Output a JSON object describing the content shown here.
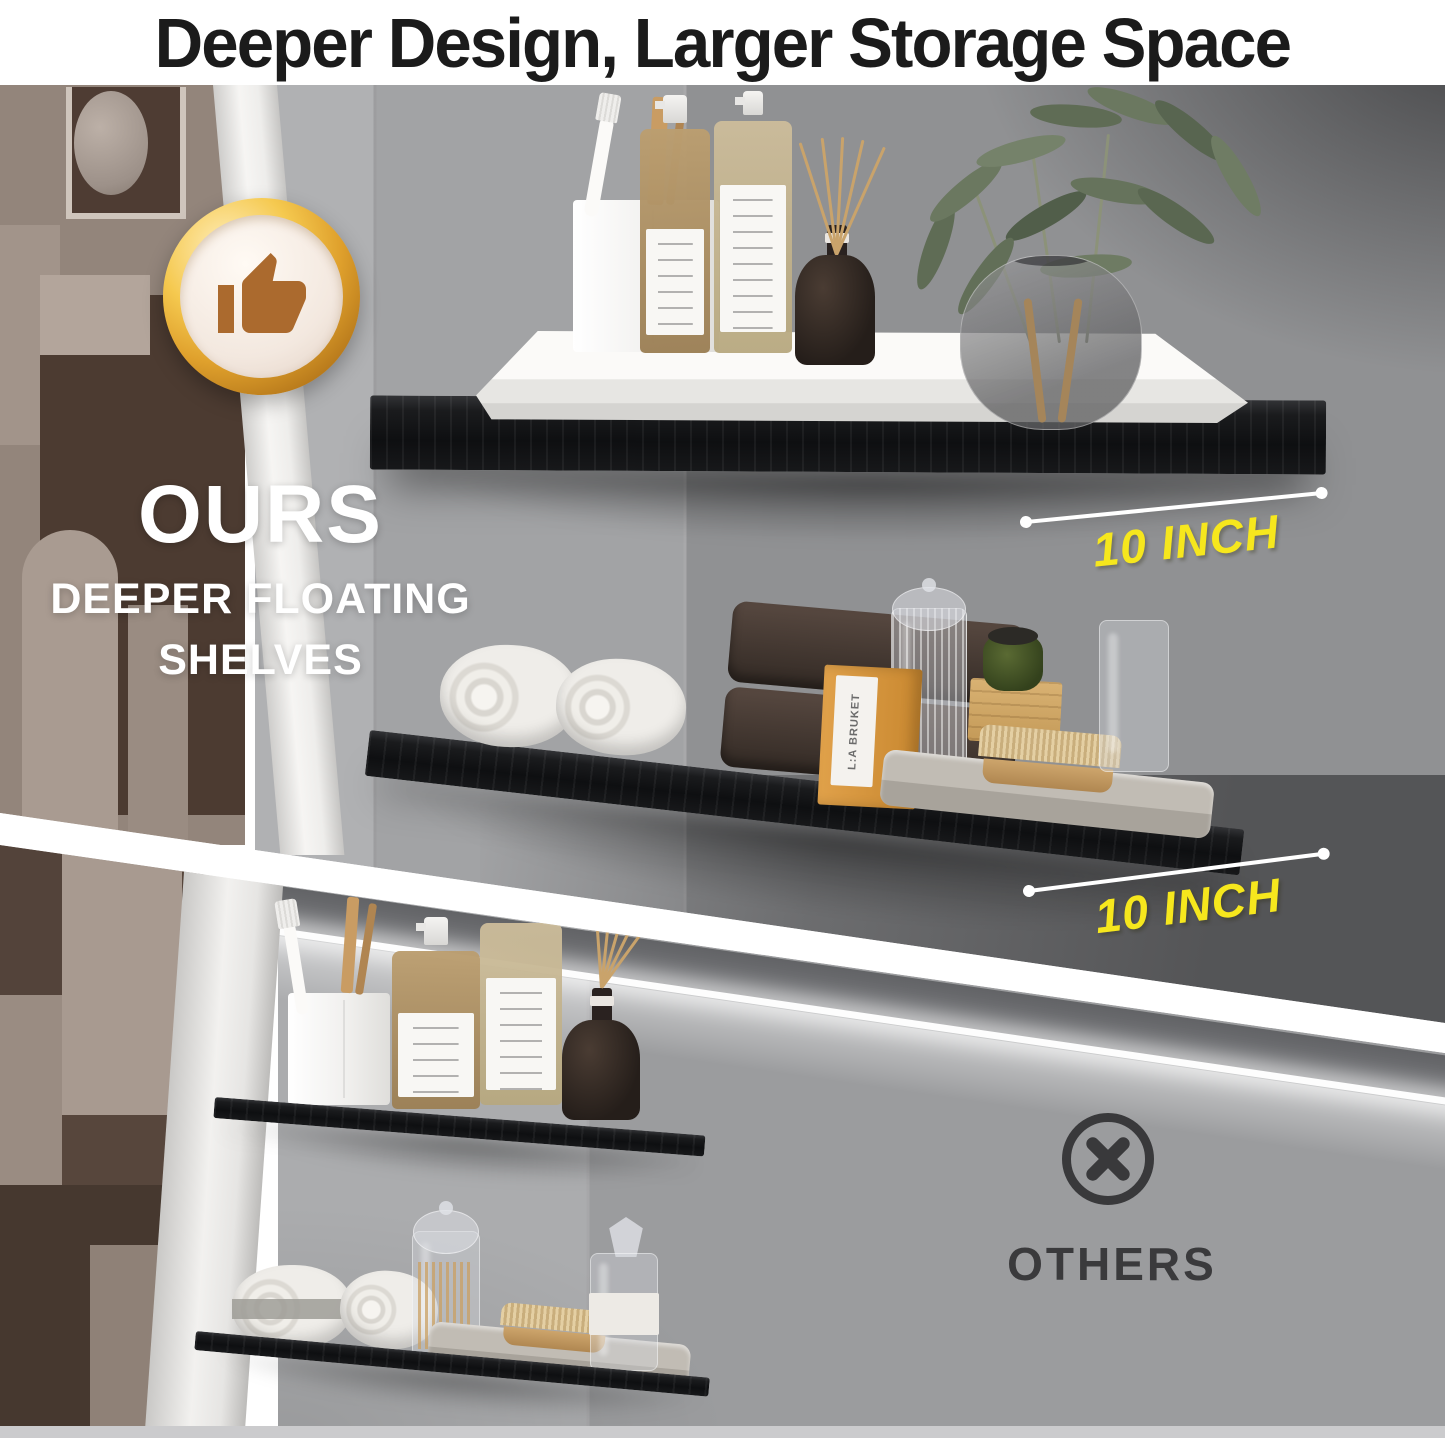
{
  "header": {
    "title": "Deeper Design, Larger Storage Space"
  },
  "ours": {
    "badge_icon": "thumbs-up-icon",
    "label": "OURS",
    "subtitle_line1": "DEEPER FLOATING",
    "subtitle_line2": "SHELVES",
    "measurements": [
      "10 INCH",
      "10 INCH"
    ],
    "shelf_box_label": "L:A BRUKET"
  },
  "others": {
    "icon": "x-circle-icon",
    "label": "OTHERS"
  },
  "colors": {
    "title_ink": "#1B1B1B",
    "measurement_yellow": "#F6E71D",
    "badge_gold": "#D9A43B",
    "badge_thumb_brown": "#AB6A2E",
    "others_ink": "#3A3A3C",
    "shelf_black": "#111214",
    "divider_white": "#FFFFFF"
  }
}
